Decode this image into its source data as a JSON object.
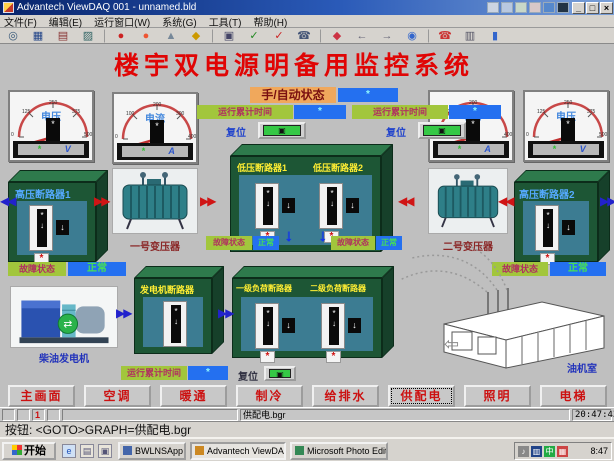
{
  "window": {
    "title": "Advantech ViewDAQ 001 - unnamed.bld",
    "minimize": "_",
    "maximize": "□",
    "close": "×"
  },
  "menu": {
    "items": [
      "文件(F)",
      "编辑(E)",
      "运行窗口(W)",
      "系统(G)",
      "工具(T)",
      "帮助(H)"
    ]
  },
  "toolbar": {
    "icons": [
      {
        "name": "zoom-icon",
        "glyph": "◎",
        "color": "#335577"
      },
      {
        "name": "display-icon",
        "glyph": "▦",
        "color": "#224488"
      },
      {
        "name": "print-icon",
        "glyph": "▤",
        "color": "#883333"
      },
      {
        "name": "trend-icon",
        "glyph": "▨",
        "color": "#336666"
      },
      {
        "name": "alarm-icon",
        "glyph": "●",
        "color": "#cc2222"
      },
      {
        "name": "alarm-ack-icon",
        "glyph": "●",
        "color": "#ee5533"
      },
      {
        "name": "tag-icon",
        "glyph": "▲",
        "color": "#778899"
      },
      {
        "name": "key-icon",
        "glyph": "◆",
        "color": "#cc9900"
      },
      {
        "name": "snapshot-icon",
        "glyph": "▣",
        "color": "#444466"
      },
      {
        "name": "confirm-icon",
        "glyph": "✓",
        "color": "#228822"
      },
      {
        "name": "cancel-icon",
        "glyph": "✓",
        "color": "#cc2222"
      },
      {
        "name": "dial-icon",
        "glyph": "☎",
        "color": "#445577"
      },
      {
        "name": "point-icon",
        "glyph": "◆",
        "color": "#cc3344"
      },
      {
        "name": "back-icon",
        "glyph": "←",
        "color": "#666677"
      },
      {
        "name": "forward-icon",
        "glyph": "→",
        "color": "#666677"
      },
      {
        "name": "world-icon",
        "glyph": "◉",
        "color": "#3366cc"
      },
      {
        "name": "phone-icon",
        "glyph": "☎",
        "color": "#cc3333"
      },
      {
        "name": "film-icon",
        "glyph": "▥",
        "color": "#555566"
      },
      {
        "name": "person-icon",
        "glyph": "▮",
        "color": "#3366cc"
      }
    ]
  },
  "main": {
    "title": "楼宇双电源明备用监控系统",
    "mode": {
      "label": "手/自动状态",
      "value": "*"
    },
    "runtime": [
      {
        "label": "运行累计时间",
        "value": "*"
      },
      {
        "label": "运行累计时间",
        "value": "*"
      }
    ],
    "reset_labels": [
      "复位",
      "复位"
    ],
    "gauges": [
      {
        "label": "电压",
        "unit": "V",
        "display": "*",
        "value": "*",
        "ticks": [
          "0",
          "125",
          "250",
          "375",
          "500"
        ]
      },
      {
        "label": "电流",
        "unit": "A",
        "display": "*",
        "value": "*",
        "ticks": [
          "0",
          "100",
          "200",
          "300",
          "400"
        ]
      },
      {
        "label": "电流",
        "unit": "A",
        "display": "*",
        "value": "*",
        "ticks": [
          "0",
          "100",
          "200",
          "300",
          "400"
        ]
      },
      {
        "label": "电压",
        "unit": "V",
        "display": "*",
        "value": "*",
        "ticks": [
          "0",
          "125",
          "250",
          "375",
          "500"
        ]
      }
    ],
    "boxes": {
      "hv1": {
        "title": "高压断路器1"
      },
      "hv2": {
        "title": "高压断路器2"
      },
      "lv": {
        "title1": "低压断路器1",
        "title2": "低压断路器2"
      },
      "gen": {
        "title": "发电机断路器"
      },
      "load": {
        "title1": "一级负荷断路器",
        "title2": "二级负荷断路器"
      }
    },
    "fault": [
      {
        "label": "故障状态",
        "value": "正常"
      },
      {
        "label": "故障状态",
        "value": "正常"
      },
      {
        "label": "故障状态",
        "value": "正常"
      },
      {
        "label": "故障状态",
        "value": "正常"
      }
    ],
    "captions": {
      "transformer1": "一号变压器",
      "transformer2": "二号变压器",
      "generator": "柴油发电机",
      "room": "油机室"
    },
    "gen_runtime": {
      "label": "运行累计时间",
      "value": "*",
      "reset": "复位"
    },
    "symbols": {
      "breaker": "*",
      "down": "↓",
      "alarm": "*"
    }
  },
  "nav": {
    "buttons": [
      "主画面",
      "空调",
      "暖通",
      "制冷",
      "给排水",
      "供配电",
      "照明",
      "电梯"
    ],
    "active": "供配电"
  },
  "statusbar": {
    "cells": [
      "",
      "",
      "1",
      ""
    ],
    "file": "供配电.bgr",
    "time": "20:47:43"
  },
  "command": {
    "text": "按钮: <GOTO>GRAPH=供配电.bgr"
  },
  "taskbar": {
    "start": "开始",
    "tasks": [
      {
        "label": "BWLNSApp"
      },
      {
        "label": "Advantech ViewDAQ 001"
      },
      {
        "label": "Microsoft Photo Editor"
      }
    ],
    "tray": {
      "time": "8:47"
    }
  }
}
